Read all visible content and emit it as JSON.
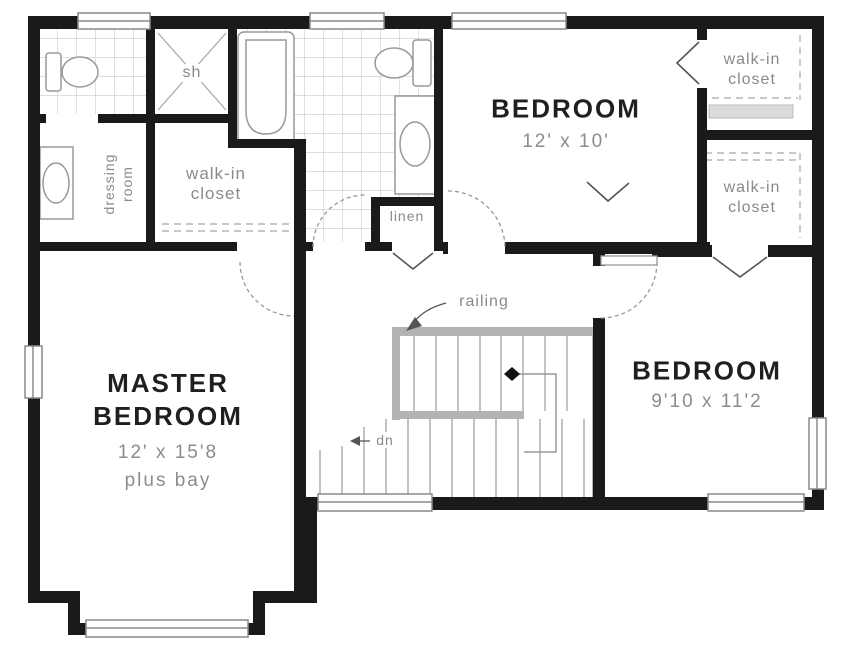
{
  "plan": {
    "rooms": {
      "master_bedroom": {
        "name_line1": "MASTER",
        "name_line2": "BEDROOM",
        "dims": "12' x 15'8",
        "note": "plus bay"
      },
      "bedroom_top": {
        "name": "BEDROOM",
        "dims": "12' x 10'"
      },
      "bedroom_right": {
        "name": "BEDROOM",
        "dims": "9'10 x 11'2"
      },
      "walk_in_closet_left": {
        "line1": "walk-in",
        "line2": "closet"
      },
      "walk_in_closet_top_right": {
        "line1": "walk-in",
        "line2": "closet"
      },
      "walk_in_closet_right": {
        "line1": "walk-in",
        "line2": "closet"
      },
      "dressing_room": {
        "line1": "dressing",
        "line2": "room"
      },
      "linen": {
        "label": "linen"
      },
      "shower": {
        "label": "sh"
      }
    },
    "annotations": {
      "railing": "railing",
      "down": "dn"
    },
    "colors": {
      "wall": "#1a1a1a",
      "fixture_stroke": "#999999",
      "tile_line": "#cccccc",
      "label_grey": "#8a8a8a"
    }
  }
}
